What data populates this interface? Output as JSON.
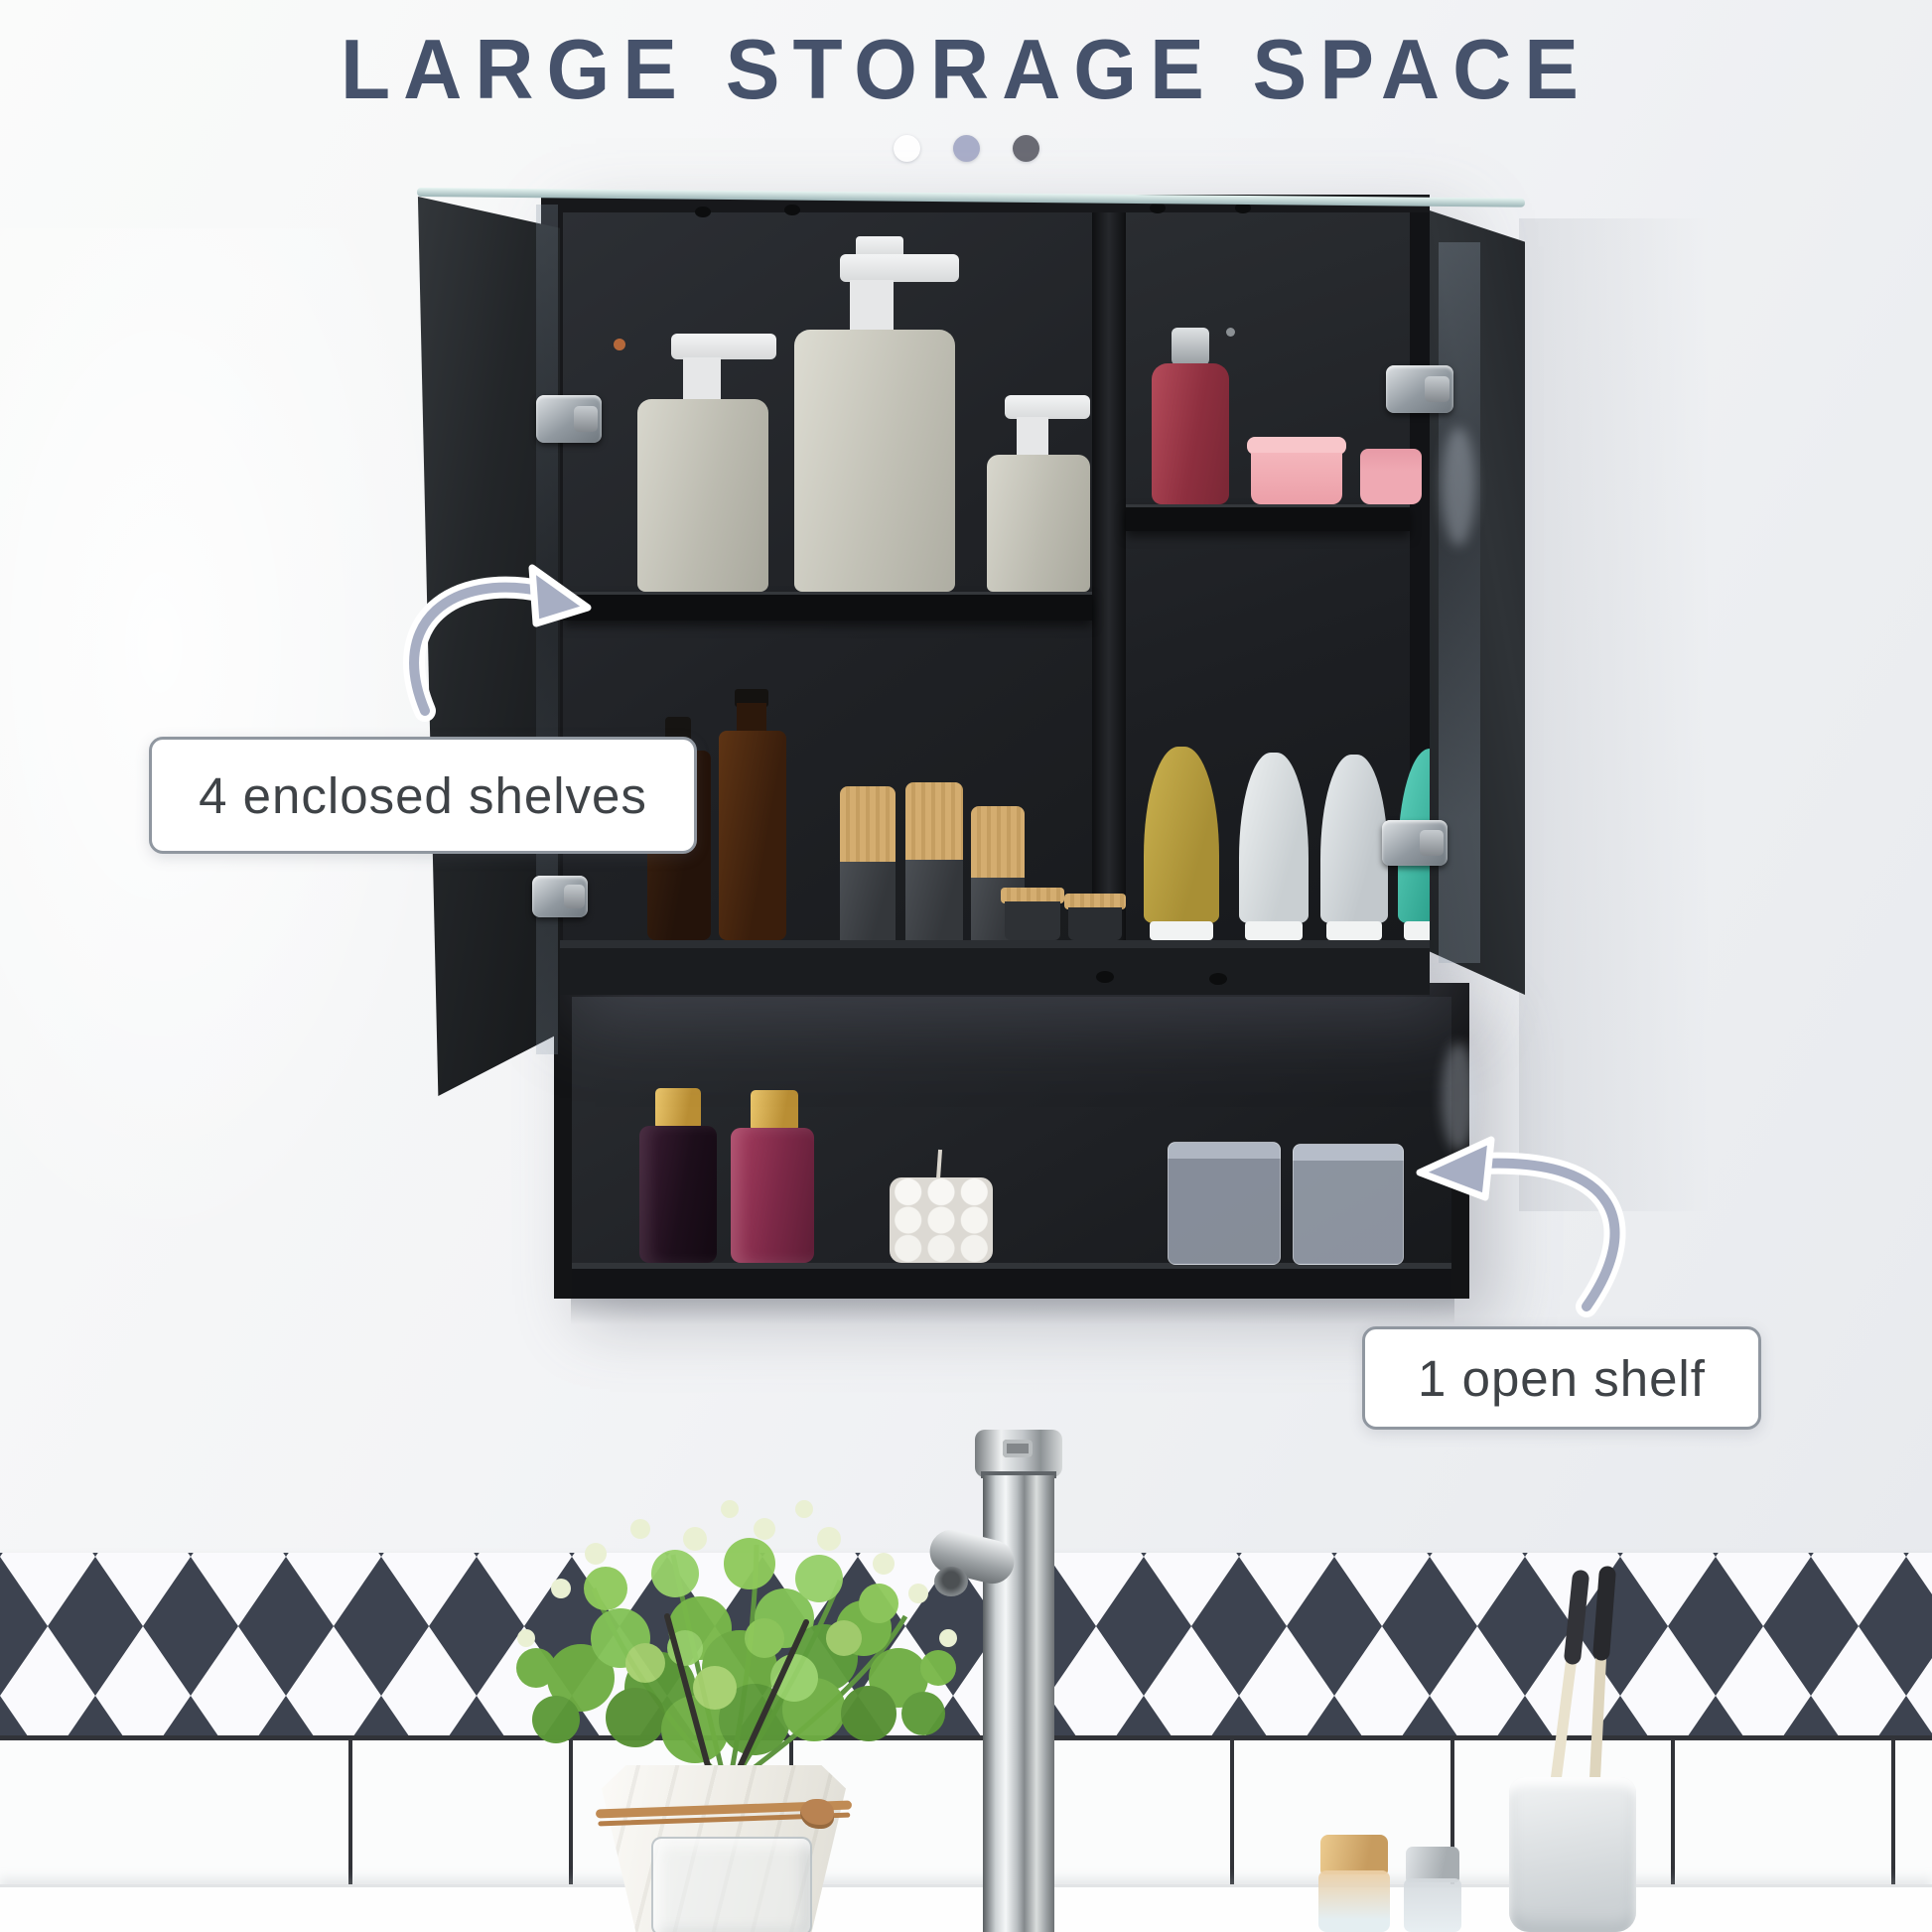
{
  "header": {
    "title": "LARGE STORAGE SPACE",
    "title_color": "#46526b"
  },
  "carousel": {
    "dots": [
      {
        "label": "slide 1",
        "color": "#ffffff",
        "active": true
      },
      {
        "label": "slide 2",
        "color": "#a9aec9",
        "active": false
      },
      {
        "label": "slide 3",
        "color": "#6a6b74",
        "active": false
      }
    ]
  },
  "callouts": {
    "enclosed": {
      "label": "4 enclosed shelves"
    },
    "open": {
      "label": "1 open shelf"
    }
  },
  "colors": {
    "title": "#46526b",
    "diamond_tile": "#3d4350",
    "cabinet": "#1d2023",
    "arrow": "#a7aec3",
    "callout_border": "#9097a0",
    "callout_text": "#3f4347"
  },
  "icons": [
    "curved-arrow-right-icon",
    "curved-arrow-left-icon"
  ]
}
